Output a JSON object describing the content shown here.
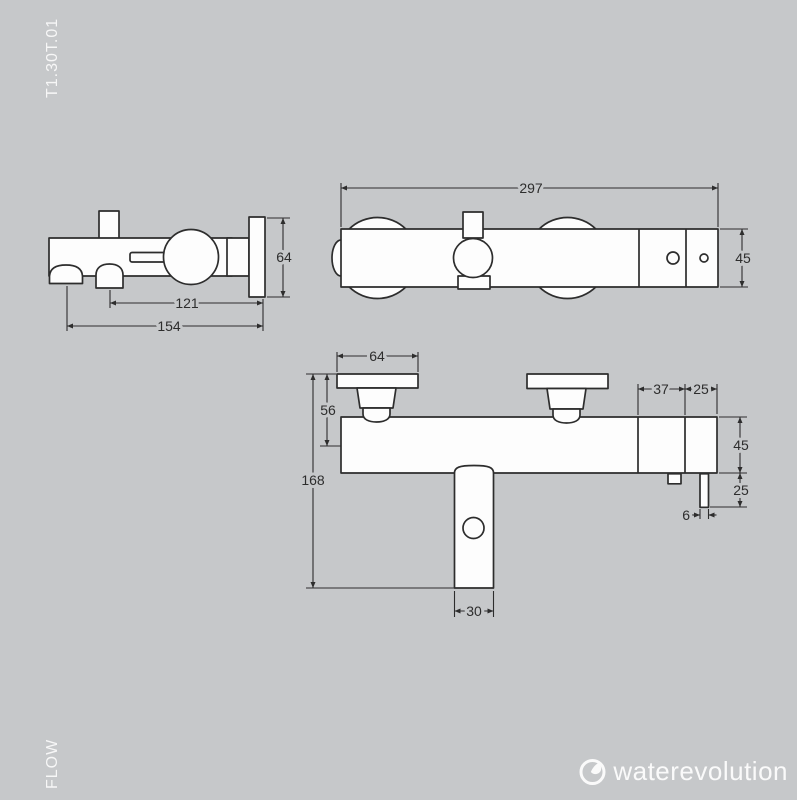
{
  "page": {
    "product_code": "T1.30T.01",
    "series_name": "FLOW"
  },
  "logo": {
    "brand": "waterevolution",
    "icon": "water-drop-icon"
  },
  "colors": {
    "background": "#c6c8ca",
    "line": "#2d2d2d",
    "shape_fill": "#fdfdfd",
    "label_text": "#f7f7f7"
  },
  "side_view": {
    "dim_plate_height": "64",
    "dim_outlet_to_wall": "121",
    "dim_total_depth": "154"
  },
  "top_view": {
    "dim_total_width": "297",
    "dim_body_depth": "45"
  },
  "front_view": {
    "dim_flange_width": "64",
    "dim_flange_to_axis": "56",
    "dim_total_height": "168",
    "dim_spout_width": "30",
    "dim_right_seg1": "37",
    "dim_right_seg2": "25",
    "dim_body_height": "45",
    "dim_rod_drop": "25",
    "dim_rod_width": "6"
  }
}
